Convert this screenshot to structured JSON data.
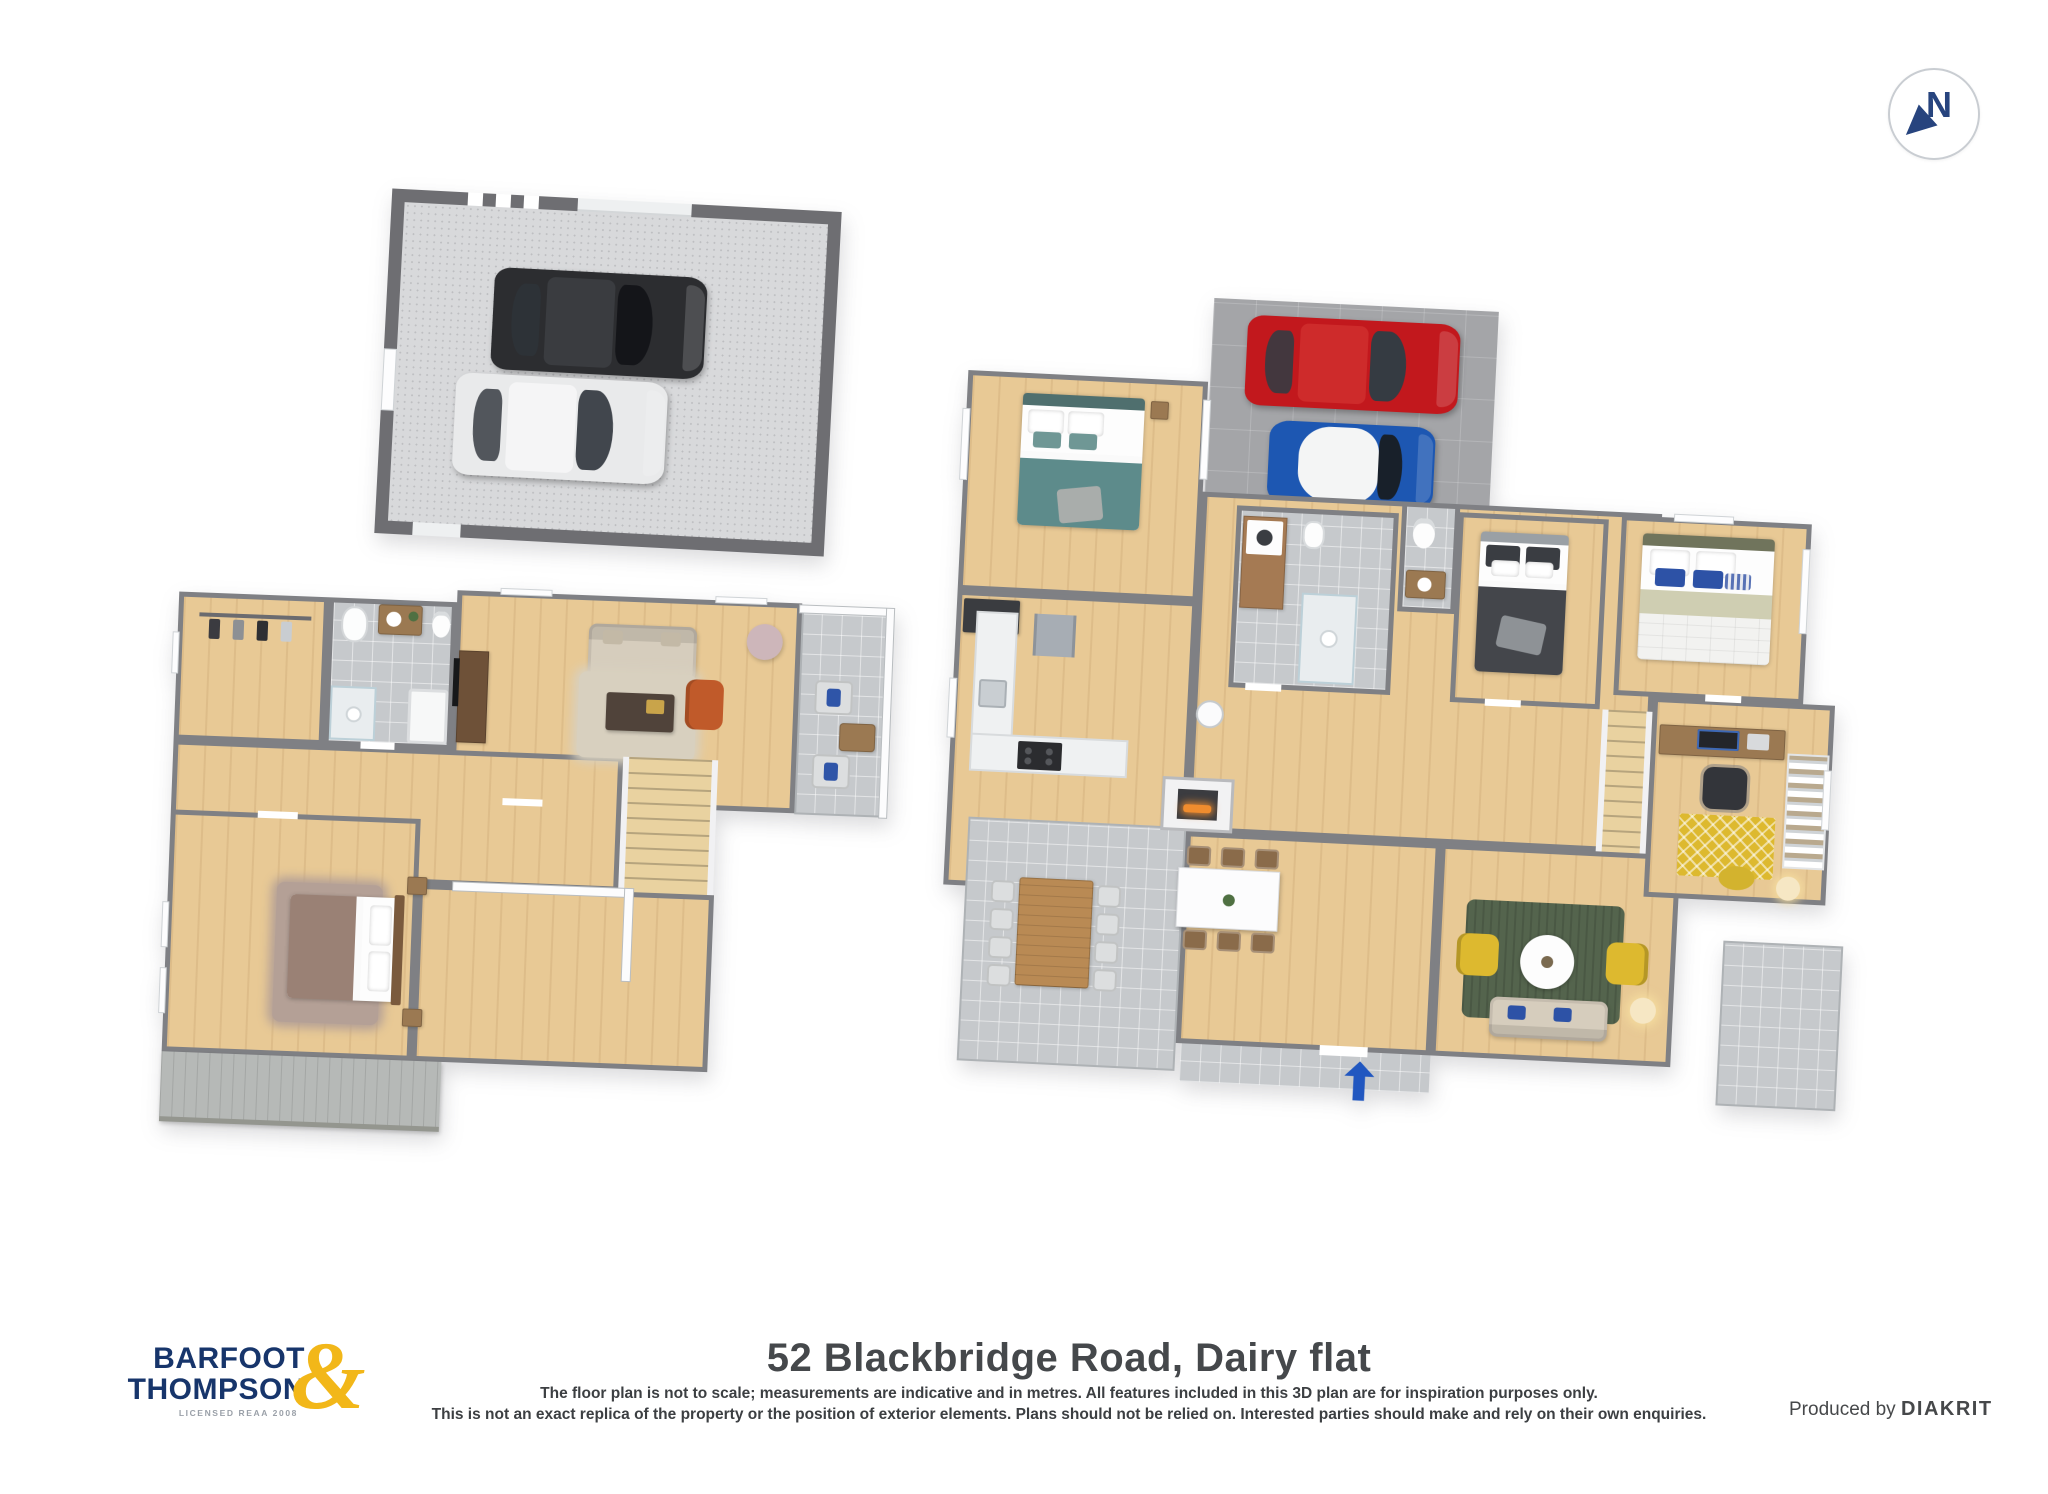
{
  "compass": {
    "label": "N",
    "letter_color": "#27447e"
  },
  "branding": {
    "logo_word1": "BARFOOT",
    "logo_word2": "THOMPSON",
    "logo_ampersand": "&",
    "logo_tagline": "LICENSED REAA 2008",
    "navy": "#17356b",
    "gold": "#f2b719"
  },
  "footer": {
    "title": "52 Blackbridge Road, Dairy flat",
    "disclaimer_line1": "The floor plan is not to scale; measurements are indicative and in metres. All features included in this 3D plan are for inspiration purposes only.",
    "disclaimer_line2": "This is not an exact replica of the property or the position of exterior elements. Plans should not be relied on. Interested parties should make and rely on their own enquiries.",
    "credit_prefix": "Produced by",
    "credit_brand": "DIAKRIT"
  },
  "palette": {
    "wall": "#7f8084",
    "wood_floor": "#e8c995",
    "tile_floor": "#c6c9cc",
    "driveway": "#a4a5a8",
    "entry_arrow": "#2157c0",
    "car_red": "#c2181d",
    "car_blue": "#1d57b2",
    "car_black": "#2c2d30",
    "car_white": "#e9eaeb",
    "bed_teal": "#5d8b8b",
    "bed_dark": "#44464b",
    "bed_mauve": "#9a8175",
    "rug_green": "#54644d",
    "accent_yellow": "#ddb92f",
    "fire_orange": "#f08c2e"
  },
  "levels": {
    "garage": {
      "items": [
        "black-car",
        "white-car",
        "garage-door",
        "garage-windows"
      ]
    },
    "lower_level": {
      "items": [
        "wardrobe",
        "bathroom",
        "living-room",
        "balcony",
        "stairs",
        "bedroom",
        "deck",
        "tv-cabinet"
      ]
    },
    "main_level": {
      "items": [
        "driveway",
        "red-car",
        "blue-car",
        "bedroom-teal",
        "kitchen",
        "laundry-bathroom",
        "wc",
        "bedroom-gray",
        "bedroom-blue",
        "home-office",
        "stairs",
        "living-room",
        "dining-room",
        "fireplace",
        "patio",
        "terrace",
        "entrance-arrow"
      ]
    }
  }
}
